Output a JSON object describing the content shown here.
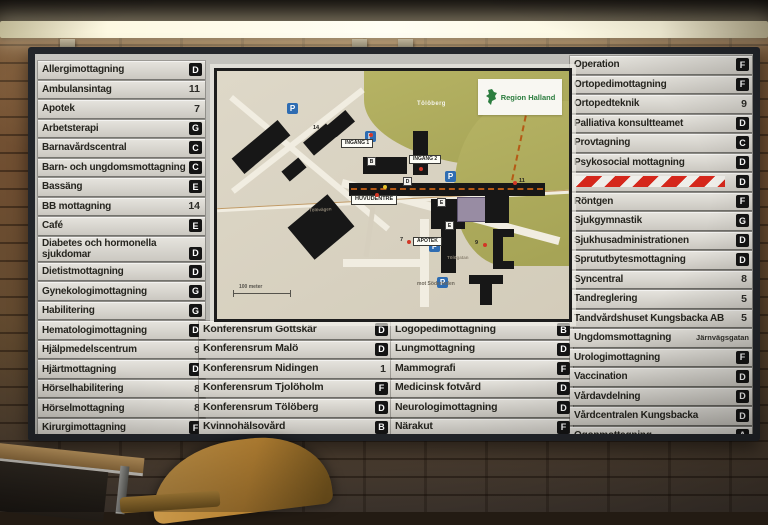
{
  "board": {
    "left_column": [
      {
        "label": "Allergimottagning",
        "badge": "D",
        "type": "letter"
      },
      {
        "label": "Ambulansintag",
        "badge": "11",
        "type": "number"
      },
      {
        "label": "Apotek",
        "badge": "7",
        "type": "number"
      },
      {
        "label": "Arbetsterapi",
        "badge": "G",
        "type": "letter"
      },
      {
        "label": "Barnavårdscentral",
        "badge": "C",
        "type": "letter"
      },
      {
        "label": "Barn- och ungdomsmottagning",
        "badge": "C",
        "type": "letter"
      },
      {
        "label": "Bassäng",
        "badge": "E",
        "type": "letter"
      },
      {
        "label": "BB mottagning",
        "badge": "14",
        "type": "number"
      },
      {
        "label": "Café",
        "badge": "E",
        "type": "letter"
      },
      {
        "label": "Diabetes och hormonella sjukdomar",
        "badge": "D",
        "type": "letter"
      },
      {
        "label": "Dietistmottagning",
        "badge": "D",
        "type": "letter"
      },
      {
        "label": "Gynekologimottagning",
        "badge": "G",
        "type": "letter"
      },
      {
        "label": "Habilitering",
        "badge": "G",
        "type": "letter"
      },
      {
        "label": "Hematologimottagning",
        "badge": "D",
        "type": "letter"
      },
      {
        "label": "Hjälpmedelscentrum",
        "badge": "9",
        "type": "number"
      },
      {
        "label": "Hjärtmottagning",
        "badge": "D",
        "type": "letter"
      },
      {
        "label": "Hörselhabilitering",
        "badge": "8",
        "type": "number"
      },
      {
        "label": "Hörselmottagning",
        "badge": "8",
        "type": "number"
      },
      {
        "label": "Kirurgimottagning",
        "badge": "F",
        "type": "letter"
      }
    ],
    "mid_left_column": [
      {
        "label": "Konferensrum Gottskär",
        "badge": "D",
        "type": "letter"
      },
      {
        "label": "Konferensrum Malö",
        "badge": "D",
        "type": "letter"
      },
      {
        "label": "Konferensrum Nidingen",
        "badge": "1",
        "type": "number"
      },
      {
        "label": "Konferensrum Tjolöholm",
        "badge": "F",
        "type": "letter"
      },
      {
        "label": "Konferensrum Tölöberg",
        "badge": "D",
        "type": "letter"
      },
      {
        "label": "Kvinnohälsovård",
        "badge": "B",
        "type": "letter"
      }
    ],
    "mid_right_column": [
      {
        "label": "Logopedimottagning",
        "badge": "B",
        "type": "letter"
      },
      {
        "label": "Lungmottagning",
        "badge": "D",
        "type": "letter"
      },
      {
        "label": "Mammografi",
        "badge": "F",
        "type": "letter"
      },
      {
        "label": "Medicinsk fotvård",
        "badge": "D",
        "type": "letter"
      },
      {
        "label": "Neurologimottagning",
        "badge": "D",
        "type": "letter"
      },
      {
        "label": "Närakut",
        "badge": "F",
        "type": "letter"
      }
    ],
    "right_column": [
      {
        "label": "Operation",
        "badge": "F",
        "type": "letter"
      },
      {
        "label": "Ortopedimottagning",
        "badge": "F",
        "type": "letter"
      },
      {
        "label": "Ortopedteknik",
        "badge": "9",
        "type": "number"
      },
      {
        "label": "Palliativa konsultteamet",
        "badge": "D",
        "type": "letter"
      },
      {
        "label": "Provtagning",
        "badge": "C",
        "type": "letter"
      },
      {
        "label": "Psykosocial mottagning",
        "badge": "D",
        "type": "letter"
      },
      {
        "label": "",
        "badge": "D",
        "type": "stripes"
      },
      {
        "label": "Röntgen",
        "badge": "F",
        "type": "letter"
      },
      {
        "label": "Sjukgymnastik",
        "badge": "G",
        "type": "letter"
      },
      {
        "label": "Sjukhusadministrationen",
        "badge": "D",
        "type": "letter"
      },
      {
        "label": "Sprututbytesmottagning",
        "badge": "D",
        "type": "letter"
      },
      {
        "label": "Syncentral",
        "badge": "8",
        "type": "number"
      },
      {
        "label": "Tandreglering",
        "badge": "5",
        "type": "number"
      },
      {
        "label": "Tandvårdshuset Kungsbacka AB",
        "badge": "5",
        "type": "number"
      },
      {
        "label": "Ungdomsmottagning",
        "badge": "Järnvägsgatan",
        "type": "text"
      },
      {
        "label": "Urologimottagning",
        "badge": "F",
        "type": "letter"
      },
      {
        "label": "Vaccination",
        "badge": "D",
        "type": "letter"
      },
      {
        "label": "Vårdavdelning",
        "badge": "D",
        "type": "letter"
      },
      {
        "label": "Vårdcentralen Kungsbacka",
        "badge": "D",
        "type": "letter"
      },
      {
        "label": "Ögonmottagning",
        "badge": "A",
        "type": "letter"
      },
      {
        "label": "Öron- näs- och halsmottagning",
        "badge": "C",
        "type": "letter"
      }
    ],
    "map": {
      "logo_text": "Region Halland",
      "park_label": "Tölöberg",
      "entrance1": "INGÅNG 1",
      "entrance2": "INGÅNG 2",
      "main_entrance": "HUVUDENTRÉ",
      "pharmacy": "APOTEK",
      "scale_label": "100 meter",
      "towards_label": "mot Söderleden",
      "street_1": "Tölövägen",
      "street_2": "Tölögatan",
      "parking_symbol": "P",
      "markers": {
        "m7": "7",
        "m9": "9",
        "m11": "11",
        "m14": "14"
      },
      "building_letters": [
        "B",
        "D",
        "E",
        "E"
      ]
    },
    "colors": {
      "badge_bg": "#141414",
      "row_bg": "#dcdad4",
      "frame": "#23262b",
      "park_green": "#aeac5c",
      "parking_blue": "#2e6cb2",
      "hazard_red": "#d5271b",
      "logo_green": "#2c7d3f",
      "route_orange": "#b55a16"
    }
  }
}
